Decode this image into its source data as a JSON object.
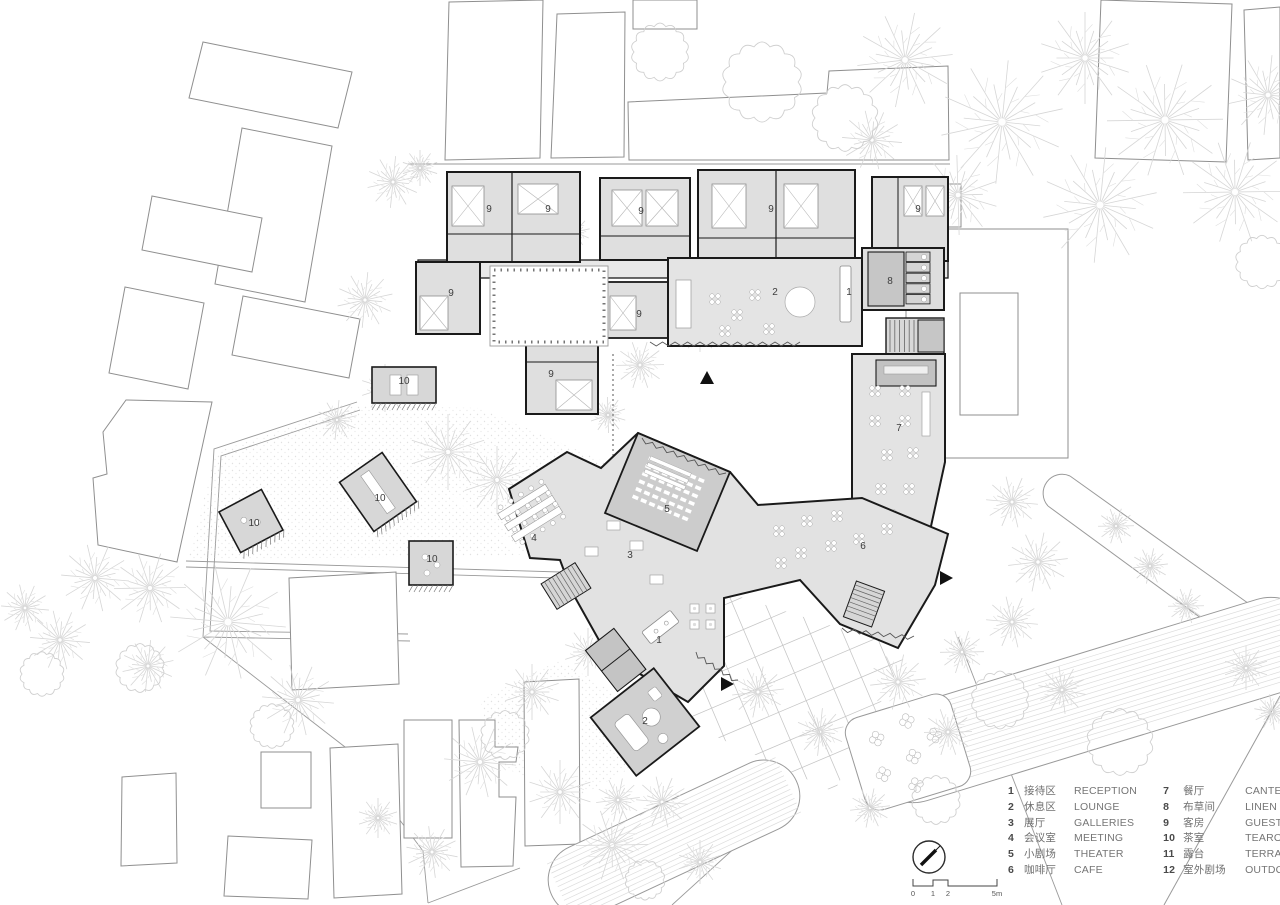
{
  "legend": {
    "columns": [
      {
        "items": [
          {
            "num": "1",
            "zh": "接待区",
            "en": "RECEPTION"
          },
          {
            "num": "2",
            "zh": "休息区",
            "en": "LOUNGE"
          },
          {
            "num": "3",
            "zh": "展厅",
            "en": "GALLERIES"
          },
          {
            "num": "4",
            "zh": "会议室",
            "en": "MEETING"
          },
          {
            "num": "5",
            "zh": "小剧场",
            "en": "THEATER"
          },
          {
            "num": "6",
            "zh": "咖啡厅",
            "en": "CAFE"
          }
        ]
      },
      {
        "items": [
          {
            "num": "7",
            "zh": "餐厅",
            "en": "CANTEEN"
          },
          {
            "num": "8",
            "zh": "布草间",
            "en": "LINEN ROOM"
          },
          {
            "num": "9",
            "zh": "客房",
            "en": "GUEST ROOM"
          },
          {
            "num": "10",
            "zh": "茶室",
            "en": "TEAROOM"
          },
          {
            "num": "11",
            "zh": "露台",
            "en": "TERRACE"
          },
          {
            "num": "12",
            "zh": "室外剧场",
            "en": "OUTDOOR THEATER"
          }
        ]
      }
    ]
  },
  "plan": {
    "room_labels": [
      {
        "n": "9",
        "x": 489,
        "y": 212
      },
      {
        "n": "9",
        "x": 548,
        "y": 212
      },
      {
        "n": "9",
        "x": 641,
        "y": 214
      },
      {
        "n": "9",
        "x": 771,
        "y": 212
      },
      {
        "n": "9",
        "x": 918,
        "y": 212
      },
      {
        "n": "9",
        "x": 451,
        "y": 296
      },
      {
        "n": "9",
        "x": 639,
        "y": 317
      },
      {
        "n": "9",
        "x": 551,
        "y": 377
      },
      {
        "n": "2",
        "x": 775,
        "y": 295
      },
      {
        "n": "1",
        "x": 849,
        "y": 295
      },
      {
        "n": "8",
        "x": 890,
        "y": 284
      },
      {
        "n": "7",
        "x": 899,
        "y": 431
      },
      {
        "n": "5",
        "x": 667,
        "y": 512
      },
      {
        "n": "3",
        "x": 630,
        "y": 558
      },
      {
        "n": "4",
        "x": 534,
        "y": 541
      },
      {
        "n": "6",
        "x": 863,
        "y": 549
      },
      {
        "n": "1",
        "x": 659,
        "y": 643
      },
      {
        "n": "2",
        "x": 645,
        "y": 724
      },
      {
        "n": "10",
        "x": 404,
        "y": 384
      },
      {
        "n": "10",
        "x": 380,
        "y": 501
      },
      {
        "n": "10",
        "x": 254,
        "y": 526
      },
      {
        "n": "10",
        "x": 432,
        "y": 562
      }
    ]
  },
  "scale_bar": {
    "ticks": [
      "0",
      "1",
      "2",
      "5m"
    ]
  },
  "colors": {
    "building_fill": "#e3e3e3",
    "room_fill": "#dfdfdf",
    "dark_room": "#c5c5c5",
    "theater_fill": "#cccccc",
    "wall": "#1a1a1a",
    "context_outline": "#8f8f8f",
    "tree": "#d6d6d6",
    "label": "#3d3d3d",
    "legend_text": "#6f6f6f"
  }
}
